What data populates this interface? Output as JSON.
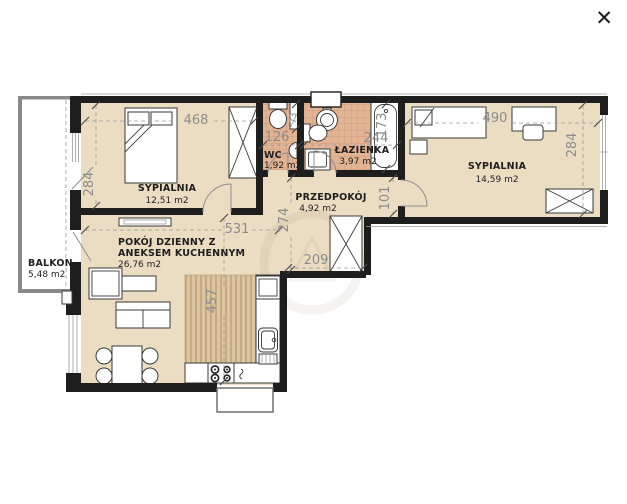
{
  "ui": {
    "close_glyph": "✕"
  },
  "rooms": {
    "bedroom1": {
      "name": "SYPIALNIA",
      "area": "12,51 m2"
    },
    "bedroom2": {
      "name": "SYPIALNIA",
      "area": "14,59 m2"
    },
    "wc": {
      "name": "WC",
      "area": "1,92 m2"
    },
    "bathroom": {
      "name": "ŁAZIENKA",
      "area": "3,97 m2"
    },
    "hallway": {
      "name": "PRZEDPOKÓJ",
      "area": "4,92 m2"
    },
    "living": {
      "name_line1": "POKÓJ DZIENNY Z",
      "name_line2": "ANEKSEM KUCHENNYM",
      "area": "26,76 m2"
    },
    "balcony": {
      "name": "BALKON",
      "area": "5,48 m2"
    }
  },
  "dimensions": {
    "bedroom1_width": "468",
    "bedroom1_depth": "284",
    "wc_width": "126",
    "wc_niche": "73",
    "bathroom_width": "244",
    "bathtub_length": "173",
    "bedroom2_width": "490",
    "bedroom2_depth": "284",
    "bedroom2_entry": "101",
    "living_width": "531",
    "hallway_depth": "274",
    "closet_width": "209",
    "living_depth": "457"
  },
  "colors": {
    "wall": "#1e1e1e",
    "floor": "#ebddc2",
    "tile": "#e3b493",
    "tile_grid": "#c89779",
    "wood": "#dcc6a2",
    "wood_stripe": "#c6ab82",
    "line": "#3a3a3a",
    "dim_text": "#8c8c8c",
    "label_text": "#1f1f1f",
    "door": "#8f8f8f"
  }
}
